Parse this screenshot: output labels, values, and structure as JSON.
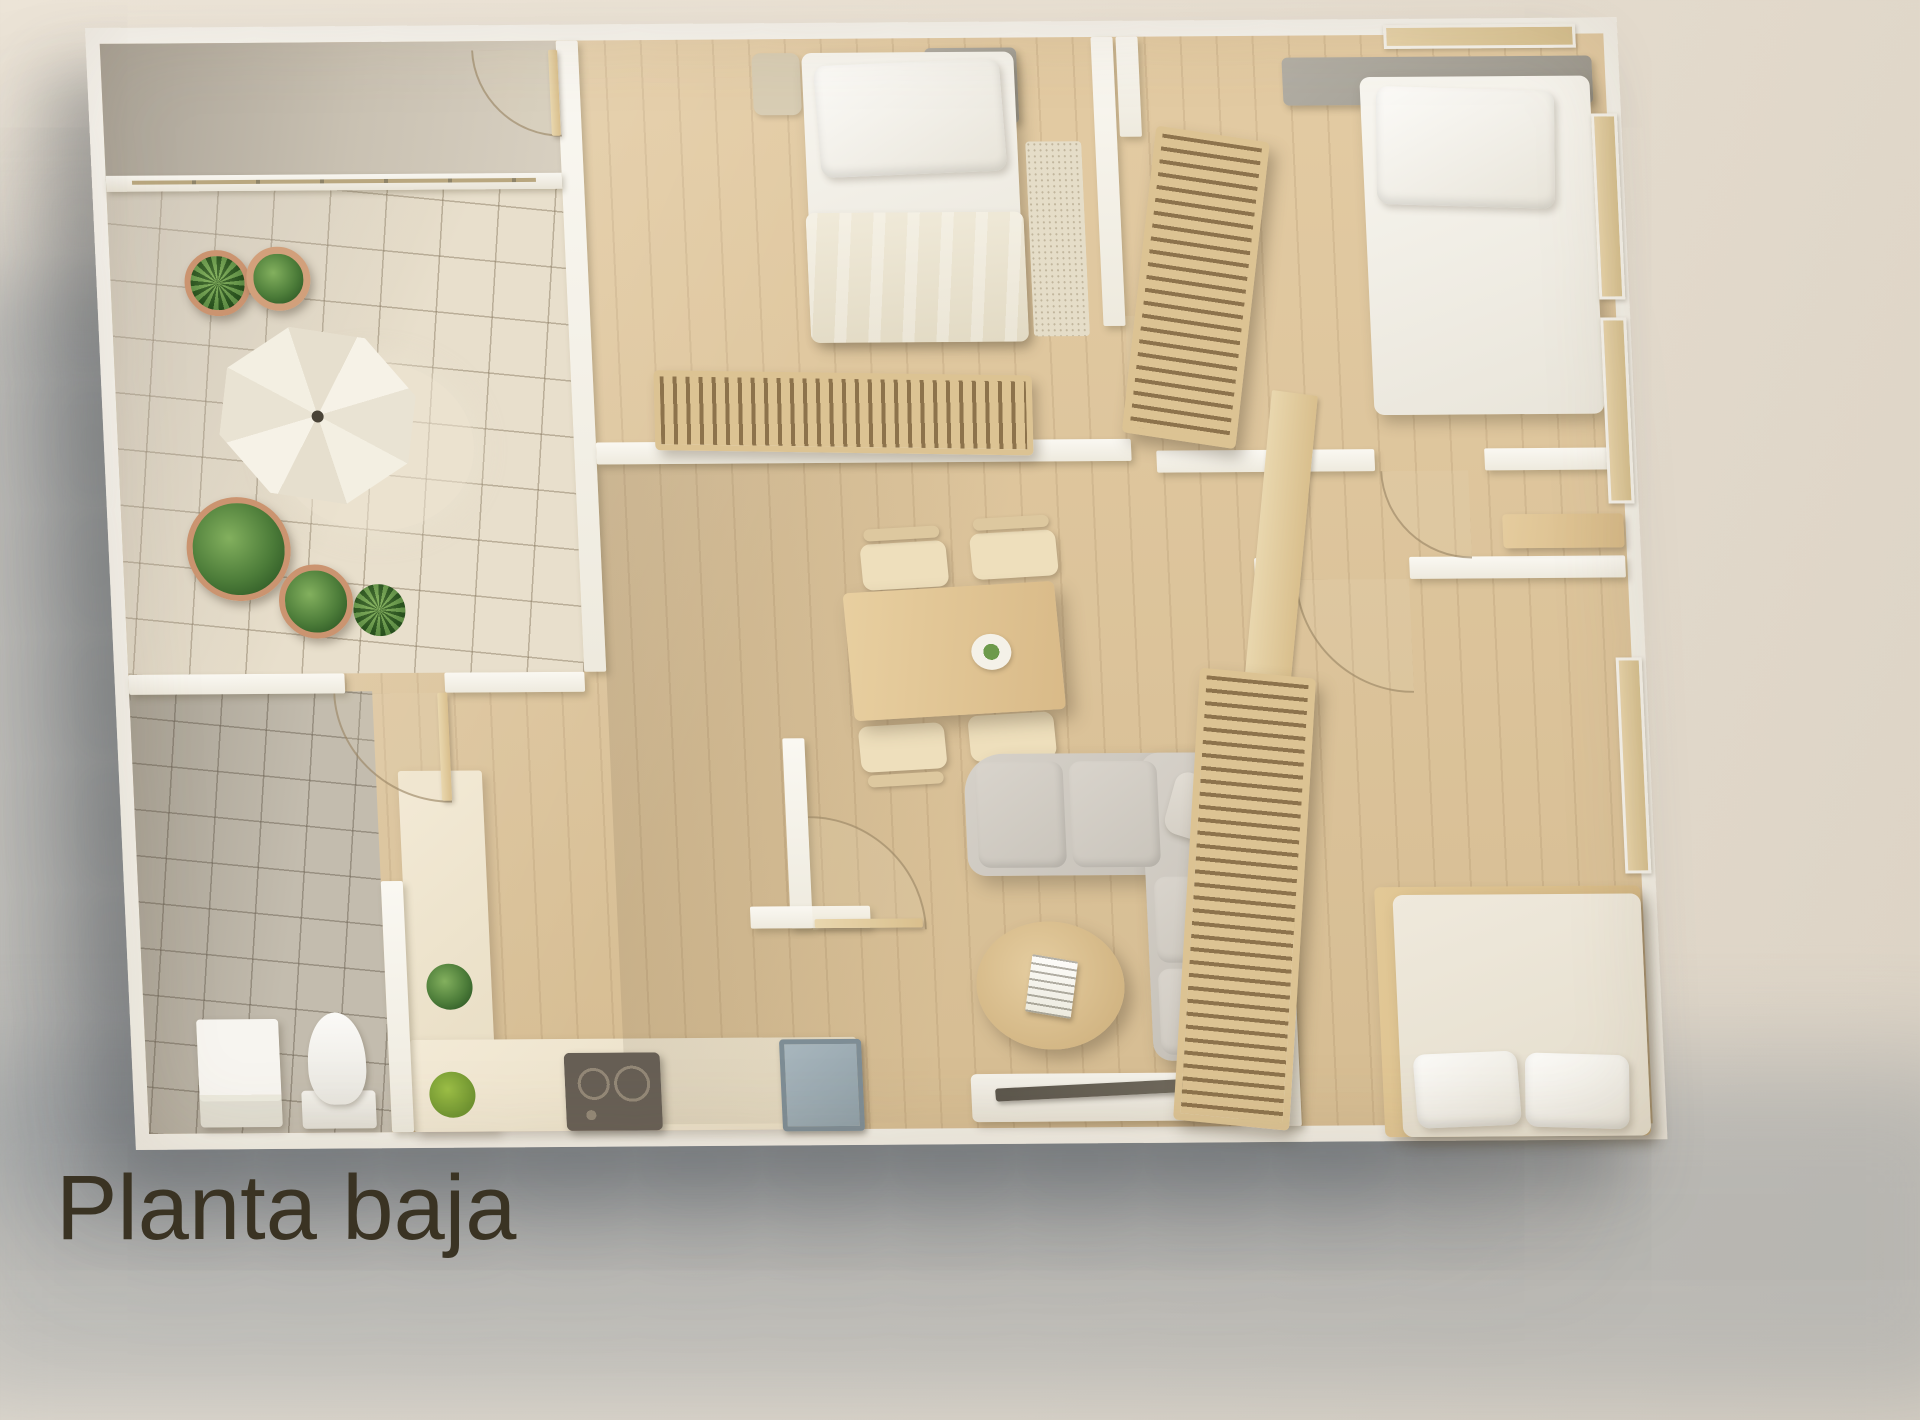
{
  "title": "Planta baja",
  "palette": {
    "background": "#e9e0d3",
    "cast_shadow": "#8b9298",
    "wall": "#f6f3ec",
    "wood_floor": "#ddc69e",
    "patio_tile": "#e8dfcc",
    "bathroom_tile": "#c3bcae",
    "louver_wood": "#dcc393",
    "sofa_fabric": "#cdc8bf",
    "bedding": "#f3f0e8",
    "plant_green": "#4d7a38",
    "pot_terracotta": "#cb9470",
    "title_color": "#3a3323"
  },
  "floorplan": {
    "label": "Planta baja",
    "rooms": [
      "patio",
      "bedroom-top-left",
      "bedroom-top-right",
      "hallway",
      "dining-area",
      "living-room",
      "bedroom-bottom-right",
      "bathroom",
      "kitchen"
    ],
    "furniture": [
      "parasol-table",
      "potted-plants",
      "double-bed",
      "single-bed",
      "louvered-wardrobes",
      "dining-table-with-four-chairs",
      "corner-sofa",
      "round-coffee-table",
      "tv-console",
      "toilet",
      "washing-machine",
      "kitchen-counter",
      "cooktop",
      "sink"
    ]
  }
}
